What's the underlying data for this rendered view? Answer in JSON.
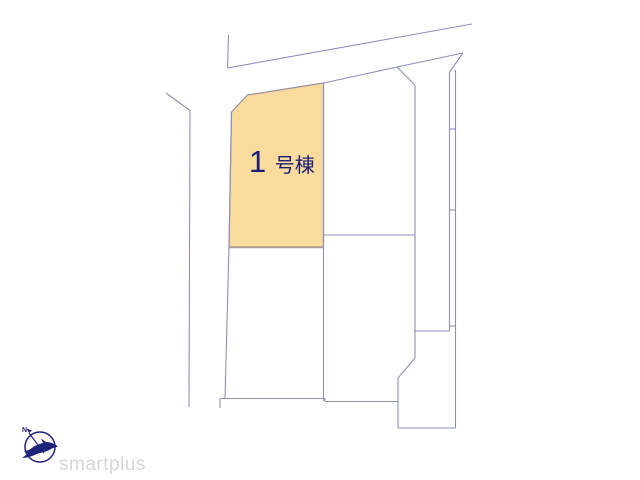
{
  "page": {
    "width_px": 640,
    "height_px": 480,
    "background_color": "#FFFFFF"
  },
  "site_plan": {
    "highlighted_lot": {
      "label": "1号棟",
      "label_number": "1",
      "label_suffix": "号棟",
      "fill_color": "#F8DB9D",
      "border_color": "#9A8FA0",
      "bottom_border_color": "#A89B90",
      "label_color": "#1B1C77"
    },
    "boundary_line_color": "#8E90BC",
    "white_lot_count": 4,
    "right_strip_segment_count": 3
  },
  "footer": {
    "logo_text": "smartplus",
    "logo_text_color": "#D6D6D6",
    "logo_icon": "bird-compass-icon",
    "logo_icon_color": "#20237A",
    "compass_label": "N"
  }
}
